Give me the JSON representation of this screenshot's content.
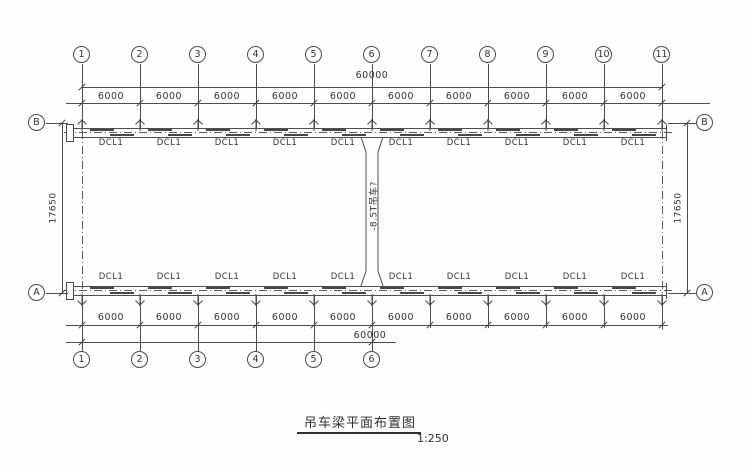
{
  "drawing": {
    "title": "吊车梁平面布置图",
    "scale": "1:250",
    "top_grid_labels": [
      "1",
      "2",
      "3",
      "4",
      "5",
      "6",
      "7",
      "8",
      "9",
      "10",
      "11"
    ],
    "bottom_grid_labels": [
      "1",
      "2",
      "3",
      "4",
      "5",
      "6"
    ],
    "row_labels": {
      "top_left": "B",
      "top_right": "B",
      "bottom_left": "A",
      "bottom_right": "A"
    },
    "top_total_dim": "60000",
    "bottom_total_dim": "60000",
    "left_height_dim": "17650",
    "right_height_dim": "17650",
    "top_bay_dims": [
      "6000",
      "6000",
      "6000",
      "6000",
      "6000",
      "6000",
      "6000",
      "6000",
      "6000",
      "6000"
    ],
    "bottom_bay_dims": [
      "6000",
      "6000",
      "6000",
      "6000",
      "6000",
      "6000",
      "6000",
      "6000",
      "6000",
      "6000"
    ],
    "top_beam_labels": [
      "DCL1",
      "DCL1",
      "DCL1",
      "DCL1",
      "DCL1",
      "DCL1",
      "DCL1",
      "DCL1",
      "DCL1",
      "DCL1"
    ],
    "bottom_beam_labels": [
      "DCL1",
      "DCL1",
      "DCL1",
      "DCL1",
      "DCL1",
      "DCL1",
      "DCL1",
      "DCL1",
      "DCL1",
      "DCL1"
    ],
    "center_note": "-8.5T吊车?",
    "line_color": "#4d4d4d",
    "text_color": "#333333"
  }
}
